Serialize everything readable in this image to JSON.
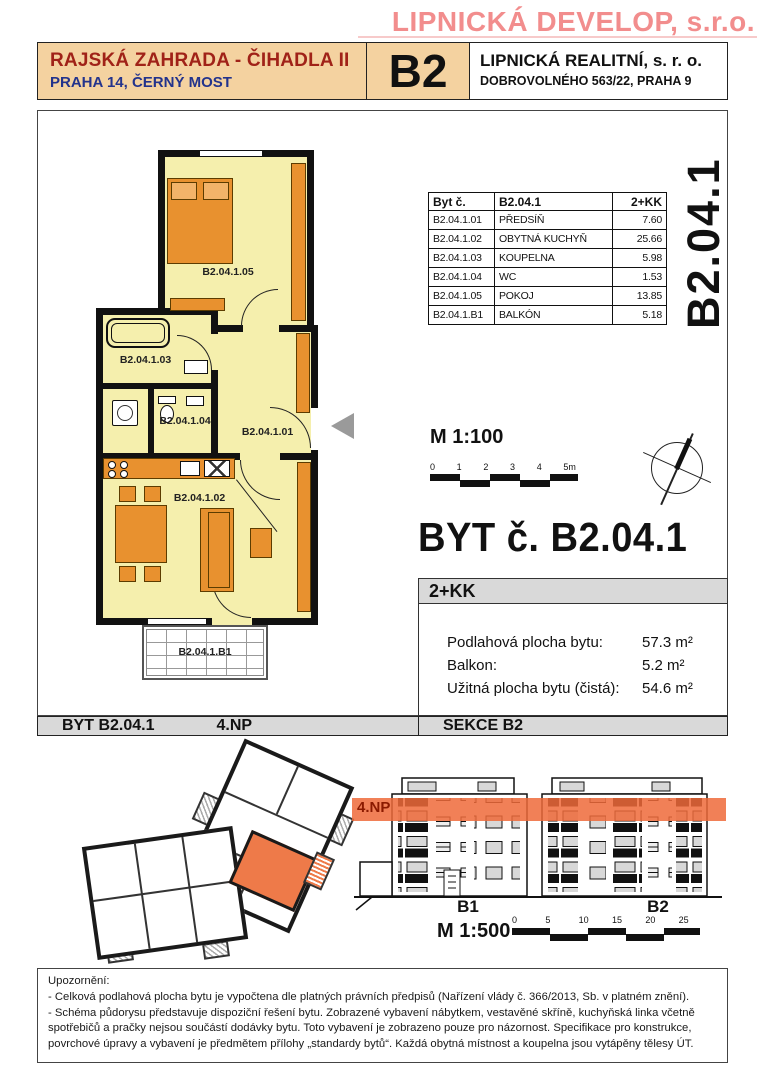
{
  "brand": {
    "developer": "LIPNICKÁ DEVELOP, s.r.o."
  },
  "header": {
    "project": "RAJSKÁ ZAHRADA - ČIHADLA II",
    "location": "PRAHA 14, ČERNÝ MOST",
    "section": "B2",
    "agency": "LIPNICKÁ REALITNÍ, s. r. o.",
    "agency_address": "DOBROVOLNÉHO 563/22, PRAHA 9"
  },
  "side_label": "B2.04.1",
  "room_table": {
    "col_unit": "Byt č.",
    "col_id": "B2.04.1",
    "col_layout": "2+KK",
    "rows": [
      {
        "code": "B2.04.1.01",
        "name": "PŘEDSÍŇ",
        "area": "7.60"
      },
      {
        "code": "B2.04.1.02",
        "name": "OBYTNÁ KUCHYŇ",
        "area": "25.66"
      },
      {
        "code": "B2.04.1.03",
        "name": "KOUPELNA",
        "area": "5.98"
      },
      {
        "code": "B2.04.1.04",
        "name": "WC",
        "area": "1.53"
      },
      {
        "code": "B2.04.1.05",
        "name": "POKOJ",
        "area": "13.85"
      },
      {
        "code": "B2.04.1.B1",
        "name": "BALKÓN",
        "area": "5.18"
      }
    ]
  },
  "plan": {
    "rooms": {
      "hall": "B2.04.1.01",
      "living": "B2.04.1.02",
      "bath": "B2.04.1.03",
      "wc": "B2.04.1.04",
      "bedroom": "B2.04.1.05",
      "balcony": "B2.04.1.B1"
    },
    "scale": {
      "label": "M 1:100",
      "ticks": [
        "0",
        "1",
        "2",
        "3",
        "4",
        "5m"
      ]
    }
  },
  "title": "BYT č. B2.04.1",
  "info": {
    "layout": "2+KK",
    "rows": [
      {
        "label": "Podlahová plocha bytu:",
        "value": "57.3 m²"
      },
      {
        "label": "Balkon:",
        "value": "5.2 m²"
      },
      {
        "label": "Užitná plocha bytu (čistá):",
        "value": "54.6 m²"
      }
    ]
  },
  "footer": {
    "unit": "BYT B2.04.1",
    "floor": "4.NP",
    "section": "SEKCE B2"
  },
  "elevation": {
    "floor_label": "4.NP",
    "building_1": "B1",
    "building_2": "B2",
    "scale": {
      "label": "M 1:500",
      "ticks": [
        "0",
        "5",
        "10",
        "15",
        "20",
        "25"
      ]
    }
  },
  "notice": {
    "title": "Upozornění:",
    "line1": "- Celková podlahová plocha bytu je vypočtena dle platných právních předpisů (Nařízení vlády č. 366/2013, Sb. v platném znění).",
    "line2": "- Schéma půdorysu představuje dispoziční řešení bytu. Zobrazené vybavení nábytkem, vestavěné skříně, kuchyňská linka včetně spotřebičů a pračky nejsou součástí dodávky bytu. Toto vybavení je zobrazeno pouze pro názornost. Specifikace pro konstrukce, povrchové úpravy a vybavení je předmětem přílohy „standardy bytů“. Každá obytná místnost a koupelna jsou vytápěny tělesy ÚT."
  },
  "colors": {
    "brand_pink": "#F28D8D",
    "header_peach": "#F4D2A0",
    "project_red": "#A02218",
    "location_blue": "#23338C",
    "plan_fill": "#F5EFAD",
    "furniture_orange": "#E8912F",
    "highlight_orange": "#EE6A39",
    "bar_gray": "#D9D9D9"
  }
}
